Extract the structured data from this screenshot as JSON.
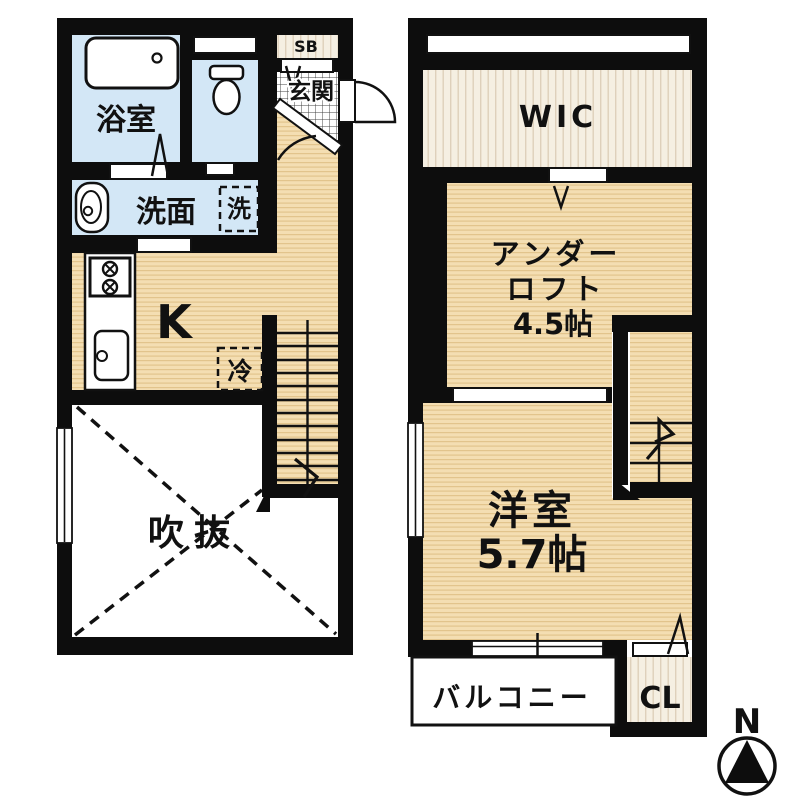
{
  "meta": {
    "type": "apartment-floor-plan",
    "floors": 2
  },
  "colors": {
    "wall": "#0d0d0d",
    "wet_room_blue": "#d3e7f6",
    "wood_floor": "#f4deb2",
    "wood_floor_stripe": "#e2c48c",
    "closet_cream": "#f5efe2",
    "closet_stripe": "#ded0bb",
    "tile_line": "#444444"
  },
  "floor1": {
    "bath": "浴室",
    "washroom": "洗面",
    "washer": "洗",
    "shoe_box": "SB",
    "entrance": "玄関",
    "kitchen": "K",
    "fridge": "冷",
    "void": "吹抜"
  },
  "floor2": {
    "wic": "WIC",
    "under_loft_line1": "アンダー",
    "under_loft_line2": "ロフト",
    "under_loft_size": "4.5帖",
    "western_room": "洋室",
    "western_room_size": "5.7帖",
    "balcony": "バルコニー",
    "closet": "CL"
  },
  "compass": {
    "north": "N"
  }
}
